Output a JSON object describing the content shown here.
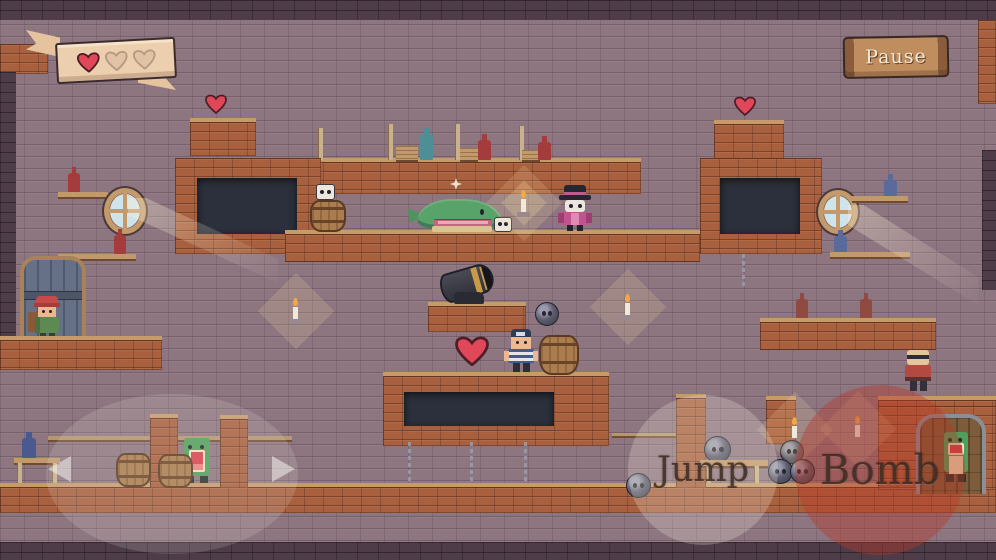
{
  "hud": {
    "pause_button": {
      "label": "Pause"
    },
    "health_banner": {
      "hearts_filled": 1,
      "hearts_total": 3
    },
    "jump_button": {
      "label": "Jump"
    },
    "bomb_button": {
      "label": "Bomb"
    },
    "dpad": {
      "left_icon": "left-arrow",
      "right_icon": "right-arrow"
    }
  },
  "scene": {
    "entities": [
      "player-sailor",
      "green-whale-enemy",
      "skull-pirate-enemy",
      "bald-pirate-enemy",
      "green-monster",
      "green-monster-in-doorway",
      "merchant-npc-red-cap",
      "cannon",
      "cannonballs",
      "barrels",
      "heart-pickups",
      "candles",
      "porthole-windows",
      "skull-blocks",
      "dark-windows",
      "shelf-bottles"
    ],
    "pickups": {
      "hearts_on_field": 3,
      "cannonballs_visible": 6
    }
  },
  "palette": {
    "wall": "#8e7681",
    "brick": "#a8603e",
    "brick_trim": "#c79a6a",
    "dark_brick": "#4e3c48",
    "window_dark": "#2b303c",
    "parchment": "#eccfae",
    "sign_wood": "#bf8d5e",
    "heart_red": "#e0485a",
    "bomb_zone_red": "rgba(186,54,38,0.40)",
    "candle_glow": "rgba(255,230,170,0.22)"
  }
}
